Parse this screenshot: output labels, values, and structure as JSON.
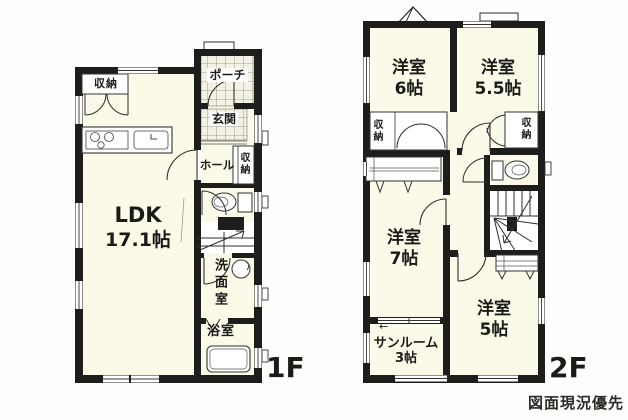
{
  "stamp": "図面現況優先",
  "floor1": {
    "label": "1F",
    "ldk_name": "LDK",
    "ldk_size": "17.1帖",
    "closet": "収納",
    "porch": "ポーチ",
    "entrance": "玄関",
    "hall": "ホール",
    "hall_closet": "収納",
    "washroom": "洗面室",
    "bathroom": "浴室"
  },
  "floor2": {
    "label": "2F",
    "bedroom6_name": "洋室",
    "bedroom6_size": "6帖",
    "bedroom55_name": "洋室",
    "bedroom55_size": "5.5帖",
    "bedroom7_name": "洋室",
    "bedroom7_size": "7帖",
    "bedroom5_name": "洋室",
    "bedroom5_size": "5帖",
    "sunroom_name": "サンルーム",
    "sunroom_size": "3帖",
    "closet_left": "収納",
    "closet_right": "収納",
    "direction_arrow": "←"
  },
  "colors": {
    "wall": "#1d1d1b",
    "room_fill": "#fbf9e8",
    "tile_fill": "#f3f1e4",
    "line": "#2f2f2f",
    "background": "#fefefd"
  }
}
